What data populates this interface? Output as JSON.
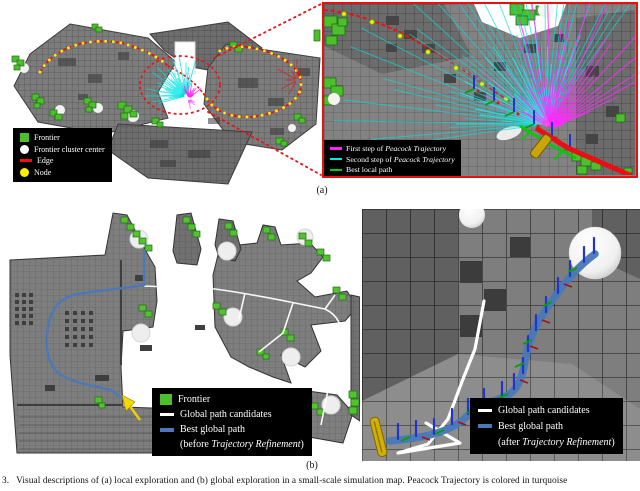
{
  "figure": {
    "panel_a_label": "(a)",
    "panel_b_label": "(b)",
    "caption": "3.   Visual descriptions of (a) local exploration and (b) global exploration in a small-scale simulation map. Peacock Trajectory is colored in turquoise"
  },
  "panel_a": {
    "map_legend": {
      "items": [
        {
          "label": "Frontier",
          "swatch": "green-square",
          "color": "#4fbe2e"
        },
        {
          "label": "Frontier cluster center",
          "swatch": "white-circle",
          "color": "#ffffff"
        },
        {
          "label": "Edge",
          "swatch": "red-line",
          "color": "#ee1111"
        },
        {
          "label": "Node",
          "swatch": "yellow-circle",
          "color": "#ffee00"
        }
      ]
    },
    "zoom_legend": {
      "items": [
        {
          "prefix": "First step of ",
          "italic": "Peacock Trajectory",
          "suffix": "",
          "swatch": "magenta-line",
          "color": "#ff22ff"
        },
        {
          "prefix": "Second step of ",
          "italic": "Peacock Trajectory",
          "suffix": "",
          "swatch": "cyan-line",
          "color": "#00e8e8"
        },
        {
          "prefix": "Best local path",
          "italic": "",
          "suffix": "",
          "swatch": "green-line",
          "color": "#00cc00"
        }
      ]
    }
  },
  "panel_b": {
    "map_legend": {
      "items": [
        {
          "prefix": "Frontier",
          "italic": "",
          "suffix": "",
          "swatch": "green-square",
          "color": "#4fbe2e"
        },
        {
          "prefix": "Global path candidates",
          "italic": "",
          "suffix": "",
          "swatch": "white-line",
          "color": "#ffffff"
        },
        {
          "prefix": "Best global path",
          "italic": "",
          "suffix": "",
          "swatch": "blue-line",
          "color": "#4a78b8"
        },
        {
          "prefix": "(before ",
          "italic": "Trajectory Refinement",
          "suffix": ")",
          "swatch": "none",
          "color": ""
        }
      ]
    },
    "zoom_legend": {
      "items": [
        {
          "prefix": "Global path candidates",
          "italic": "",
          "suffix": "",
          "swatch": "white-line",
          "color": "#ffffff"
        },
        {
          "prefix": "Best global path",
          "italic": "",
          "suffix": "",
          "swatch": "blue-line",
          "color": "#4a78b8"
        },
        {
          "prefix": "(after ",
          "italic": "Trajectory Refinement",
          "suffix": ")",
          "swatch": "none",
          "color": ""
        }
      ]
    }
  },
  "colors": {
    "frontier_green": "#4fbe2e",
    "edge_red": "#ee1111",
    "node_yellow": "#ffee00",
    "cluster_center_white": "#ffffff",
    "first_step_magenta": "#ff22ff",
    "second_step_cyan": "#00e8e8",
    "best_local_green": "#00cc00",
    "best_global_blue": "#4a78b8",
    "zoom_border_red": "#e81010",
    "voxel_gray": "#7d7d7d"
  }
}
